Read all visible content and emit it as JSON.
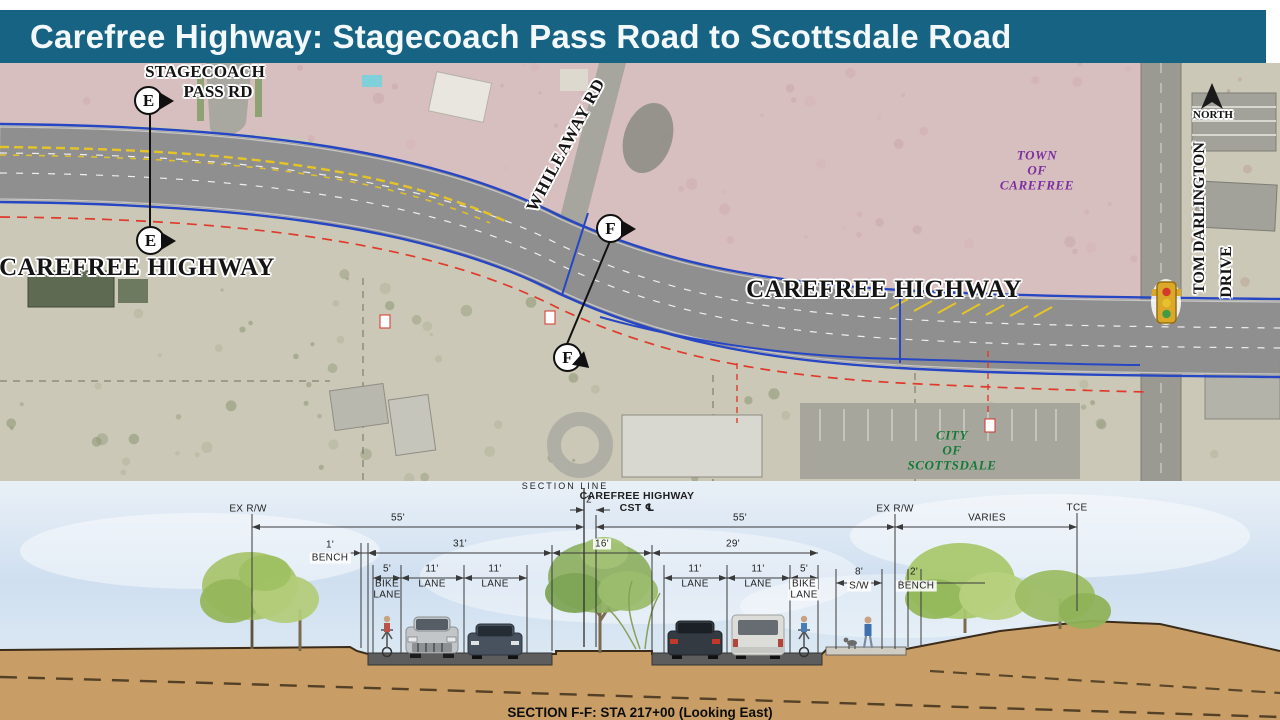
{
  "title": {
    "text": "Carefree Highway: Stagecoach Pass Road to Scottsdale Road"
  },
  "colors": {
    "title_bar": "#176384",
    "town_overlay": "#e4b6c8",
    "town_text": "#7b2fa0",
    "city_text": "#157a38",
    "road_gray": "#8f8f8f",
    "earth_tan": "#c89e66",
    "proposed_blue": "#2746c4",
    "rw_red": "#e03a2c",
    "stripe_yellow": "#e6c426"
  },
  "map": {
    "road_labels": {
      "stagecoach_line1": "STAGECOACH",
      "stagecoach_line2": "PASS RD",
      "carefree_left": "CAREFREE HIGHWAY",
      "carefree_right": "CAREFREE HIGHWAY",
      "whileaway": "WHILEAWAY RD",
      "tom_darlington": "TOM DARLINGTON",
      "tom_darlington_2": "DRIVE"
    },
    "area_labels": {
      "town": [
        "TOWN",
        "OF",
        "CAREFREE"
      ],
      "city": [
        "CITY",
        "OF",
        "SCOTTSDALE"
      ]
    },
    "north": "NORTH",
    "markers": {
      "e": "E",
      "f": "F"
    }
  },
  "section": {
    "header": {
      "section_line": "SECTION  LINE",
      "carefree": "CAREFREE HIGHWAY",
      "cst": "CST ℄",
      "ex_rw_left": "EX  R/W",
      "ex_rw_right": "EX  R/W",
      "tce": "TCE",
      "varies": "VARIES"
    },
    "dims": {
      "d55L": "55'",
      "d2": "2'",
      "d55R": "55'",
      "d1": "1'",
      "bench_l": "BENCH",
      "d31": "31'",
      "d16": "16'",
      "d29": "29'",
      "bikeL_n": "5'",
      "bikeL_1": "BIKE",
      "bikeL_2": "LANE",
      "laneL1_n": "11'",
      "laneL1": "LANE",
      "laneL2_n": "11'",
      "laneL2": "LANE",
      "laneR1_n": "11'",
      "laneR1": "LANE",
      "laneR2_n": "11'",
      "laneR2": "LANE",
      "bikeR_n": "5'",
      "bikeR_1": "BIKE",
      "bikeR_2": "LANE",
      "sw_n": "8'",
      "sw": "S/W",
      "benchR_n": "2'",
      "bench_r": "BENCH"
    },
    "caption": "SECTION F-F: STA 217+00 (Looking East)"
  }
}
